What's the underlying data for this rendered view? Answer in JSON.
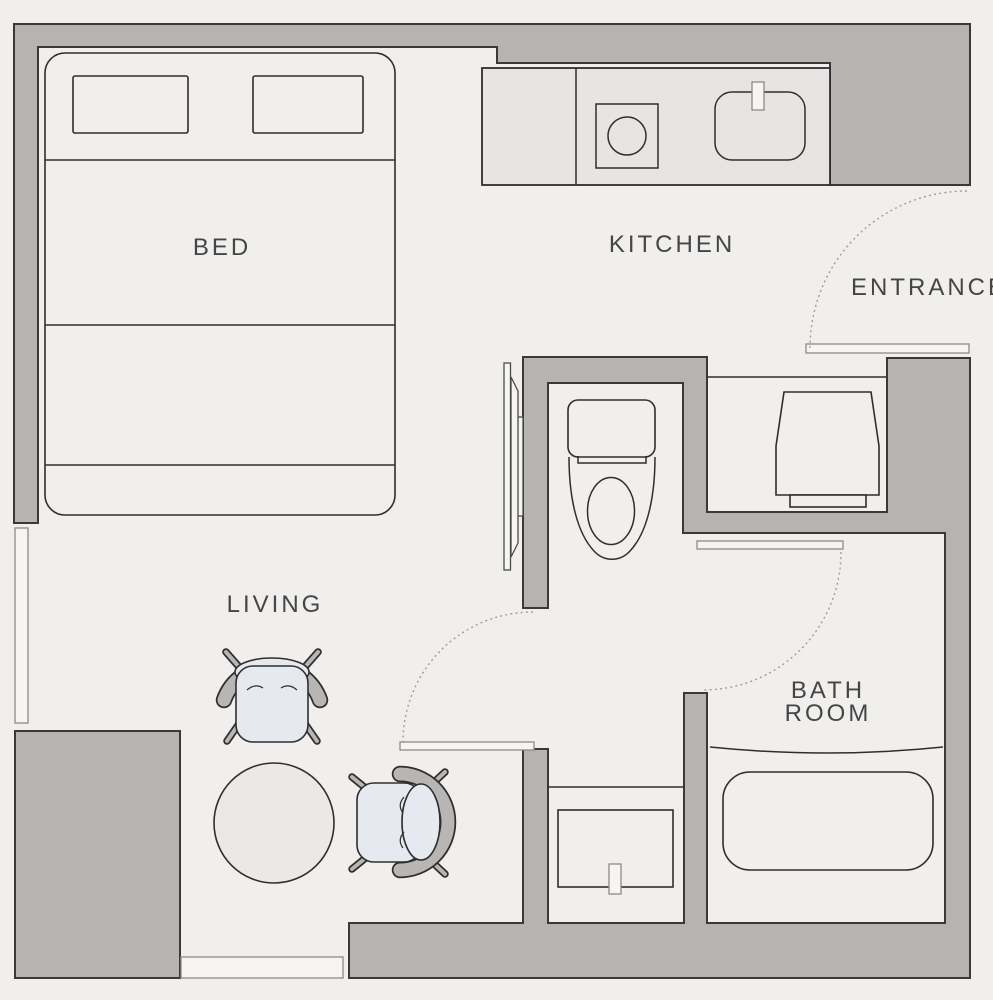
{
  "plan": {
    "type": "studio-apartment-floor-plan",
    "labels": {
      "bed": "BED",
      "kitchen": "KITCHEN",
      "entrance": "ENTRANCE",
      "living": "LIVING",
      "bathroom_line1": "BATH",
      "bathroom_line2": "ROOM"
    },
    "colors": {
      "background": "#f0efed",
      "wall_fill": "#b5b4b2",
      "wall_outline": "#3a3938",
      "counter_fill": "#e6e5e3",
      "fixture_outline": "#2f2e2d",
      "seat_fill": "#e6eaf0",
      "chair_back_fill": "#b7b6b5",
      "table_fill": "#eae9e7",
      "sill_fill": "#f6f5f3",
      "sill_outline": "#8e8b85",
      "door_swing": "#a59c90",
      "label_text": "#454545"
    },
    "fixtures": [
      "double-bed",
      "pillow-left",
      "pillow-right",
      "kitchen-counter",
      "stove",
      "kitchen-sink",
      "toilet",
      "washing-machine",
      "bathtub",
      "washbasin",
      "armchair-top",
      "armchair-right",
      "round-table"
    ],
    "openings": [
      "entrance-door-swing",
      "bathroom-door-swing",
      "hall-door-swing",
      "sliding-door",
      "window-left",
      "window-bottom"
    ]
  }
}
